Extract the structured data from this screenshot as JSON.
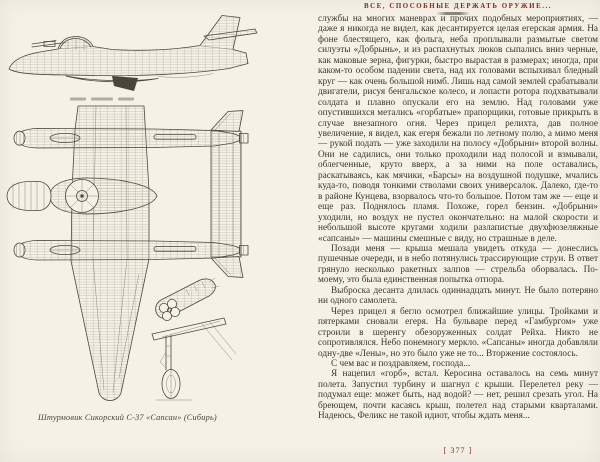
{
  "page": {
    "running_header": "ВСЕ, СПОСОБНЫЕ ДЕРЖАТЬ ОРУЖИЕ...",
    "page_number": "[ 377 ]"
  },
  "colors": {
    "paper": "#f5f1e7",
    "ink": "#3d352c",
    "accent": "#7c2e1f",
    "drawing_stroke": "#4e473d"
  },
  "figure": {
    "caption": "Штурмовик Сикорский С-37 «Сапсан» (Сибирь)"
  },
  "body": {
    "paragraphs": [
      "службы на многих маневрах и прочих подобных мероприятиях, — даже я никогда не видел, как десантируется целая егерская армия. На фоне блестящего, как фольга, неба проплывали размытые светом силуэты «Добрынь», и из распахнутых люков сыпались вниз черные, как маковые зерна, фигурки, быстро вырастая в размерах; иногда, при каком-то особом падении света, над их головами вспыхивал бледный круг — как очень большой нимб. Лишь над самой землей срабатывали двигатели, рисуя бенгальское колесо, и лопасти ротора подхватывали солдата и плавно опускали его на землю. Над головами уже опустившихся метались «горбатые» прапорщики, готовые прикрыть в случае внезапного огня. Через прицел релихта, дав полное увеличение, я видел, как егеря бежали по летному полю, а мимо меня — рукой подать — уже заходили на полосу «Добрыни» второй волны. Они не садились, они только проходили над полосой и взмывали, облегченные, круто вверх, а за ними на поле оставались, раскатываясь, как мячики, «Барсы» на воздушной подушке, мчались куда-то, поводя тонкими стволами своих универсалок. Далеко, где-то в районе Кунцева, взорвалось что-то большое. Потом там же — еще и еще раз. Поднялось пламя. Похоже, горел бензин. «Добрыни» уходили, но воздух не пустел окончательно: на малой скорости и небольшой высоте кругами ходили разлапистые двухфюзеляжные «сапсаны» — машины смешные с виду, но страшные в деле.",
      "Позади меня — крыша мешала увидеть откуда — донеслись пушечные очереди, и в небо потянулись трассирующие струи. В ответ грянуло несколько ракетных залпов — стрельба оборвалась. По-моему, это была единственная попытка отпора.",
      "Выброска десанта длилась одиннадцать минут. Не было потеряно ни одного самолета.",
      "Через прицел я бегло осмотрел ближайшие улицы. Тройками и пятерками сновали егеря. На бульваре перед «Гамбургом» уже строили в шеренгу обезоруженных солдат Рейха. Никто не сопротивлялся. Небо понемногу меркло. «Сапсаны» иногда добавляли одну-две «Лены», но это было уже не то... Вторжение состоялось.",
      "С чем вас и поздравляем, господа...",
      "Я нацепил «горб», встал. Керосина оставалось на семь минут полета. Запустил турбину и шагнул с крыши. Перелетел реку — подумал еще: может быть, над водой? — нет, решил срезать угол. На бреющем, почти касаясь крыш, полетел над старыми кварталами. Надеюсь, Феликс не такой идиот, чтобы ждать меня..."
    ]
  }
}
